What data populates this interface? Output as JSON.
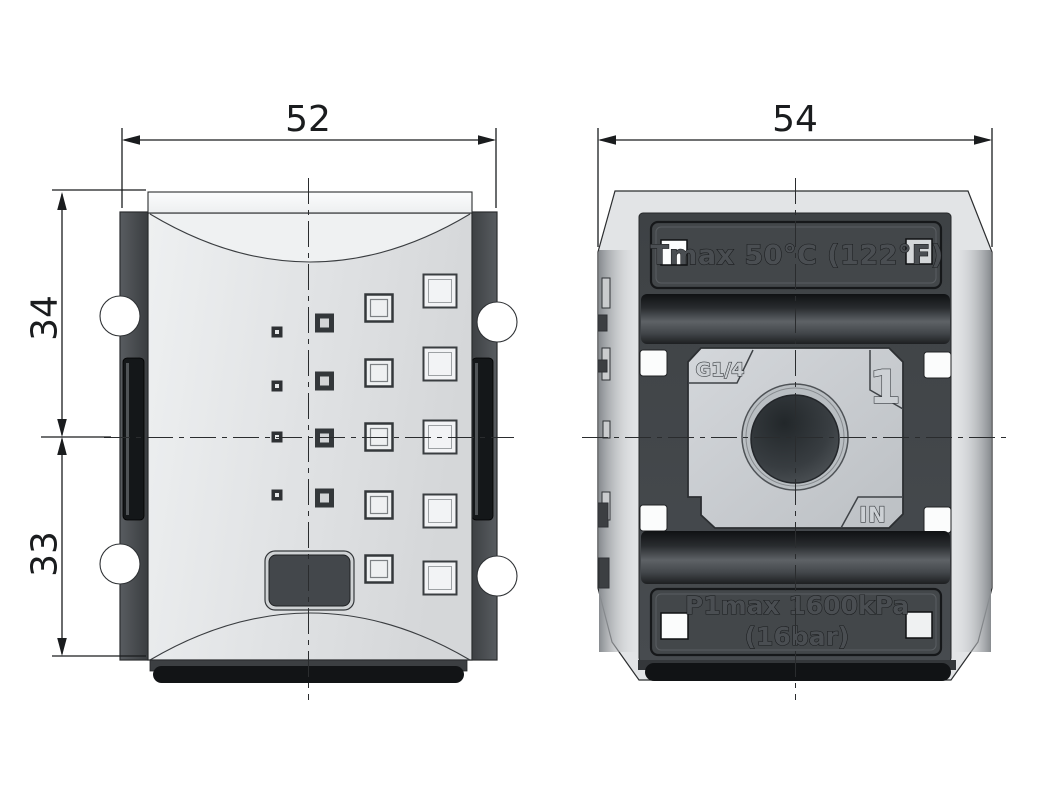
{
  "front_view": {
    "dim_width": "52",
    "dim_upper_height": "34",
    "dim_lower_height": "33"
  },
  "side_view": {
    "dim_width": "54",
    "temp_label": "Tmax 50°C (122°F)",
    "port_thread": "G1/4",
    "port_number": "1",
    "port_flow": "IN",
    "pressure_line1": "P1max 1600kPa",
    "pressure_line2": "(16bar)"
  },
  "colors": {
    "background": "#ffffff",
    "outline": "#2b2d2f",
    "body_light": "#e3e5e7",
    "panel_dark": "#44484c",
    "band_dark": "#43474b",
    "slot_black": "#16181a",
    "plate_gray": "#c9cdd1"
  }
}
